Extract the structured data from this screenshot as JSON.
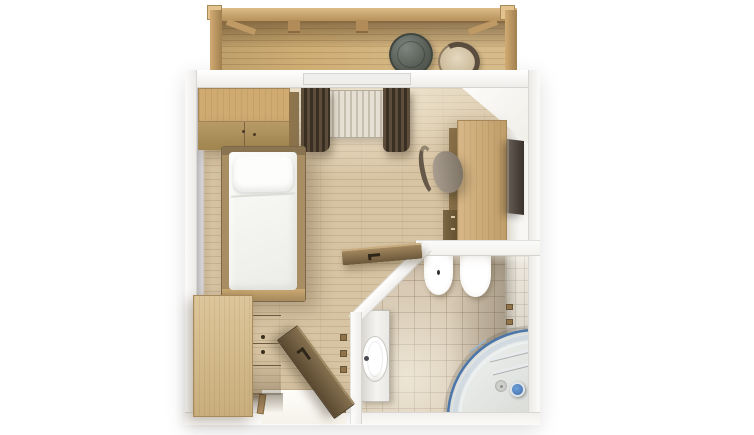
{
  "image_type": "3d-floorplan-top-view-render",
  "rooms": [
    {
      "name": "balcony",
      "items": [
        "pergola-frame",
        "wood-decking",
        "round-table",
        "wicker-chair"
      ]
    },
    {
      "name": "living-bedroom",
      "items": [
        "wardrobe",
        "single-bed",
        "window-curtains",
        "radiator",
        "desk",
        "office-chair",
        "wall-mounted-tv",
        "drawer-dresser",
        "entrance-door",
        "coat-hooks",
        "bathroom-door"
      ]
    },
    {
      "name": "bathroom",
      "items": [
        "bidet",
        "toilet",
        "washbasin",
        "corner-shower",
        "glass-shelves",
        "shower-fitting",
        "towel-hooks"
      ]
    }
  ],
  "palette": {
    "background": "#ffffff",
    "wall_white": "#fbfbfa",
    "wall_face": "#d6d4d6",
    "floor_wood": "#d7c4a3",
    "wood_light": "#d3b17a",
    "wood_mid": "#a0854f",
    "wood_dark": "#8a7350",
    "door_wood": "#5a4931",
    "curtain_brown": "#3a2f23",
    "linen_white": "#fbfbf9",
    "tile_floor": "#d8cab4",
    "tile_wall": "#eae4d7",
    "fixture_white": "#ffffff",
    "glass_blue": "#3f6fa8",
    "table_gray": "#565c54",
    "wicker": "#e4d8c0",
    "radiator": "#e6e0d4",
    "tv_dark": "#39322b"
  }
}
